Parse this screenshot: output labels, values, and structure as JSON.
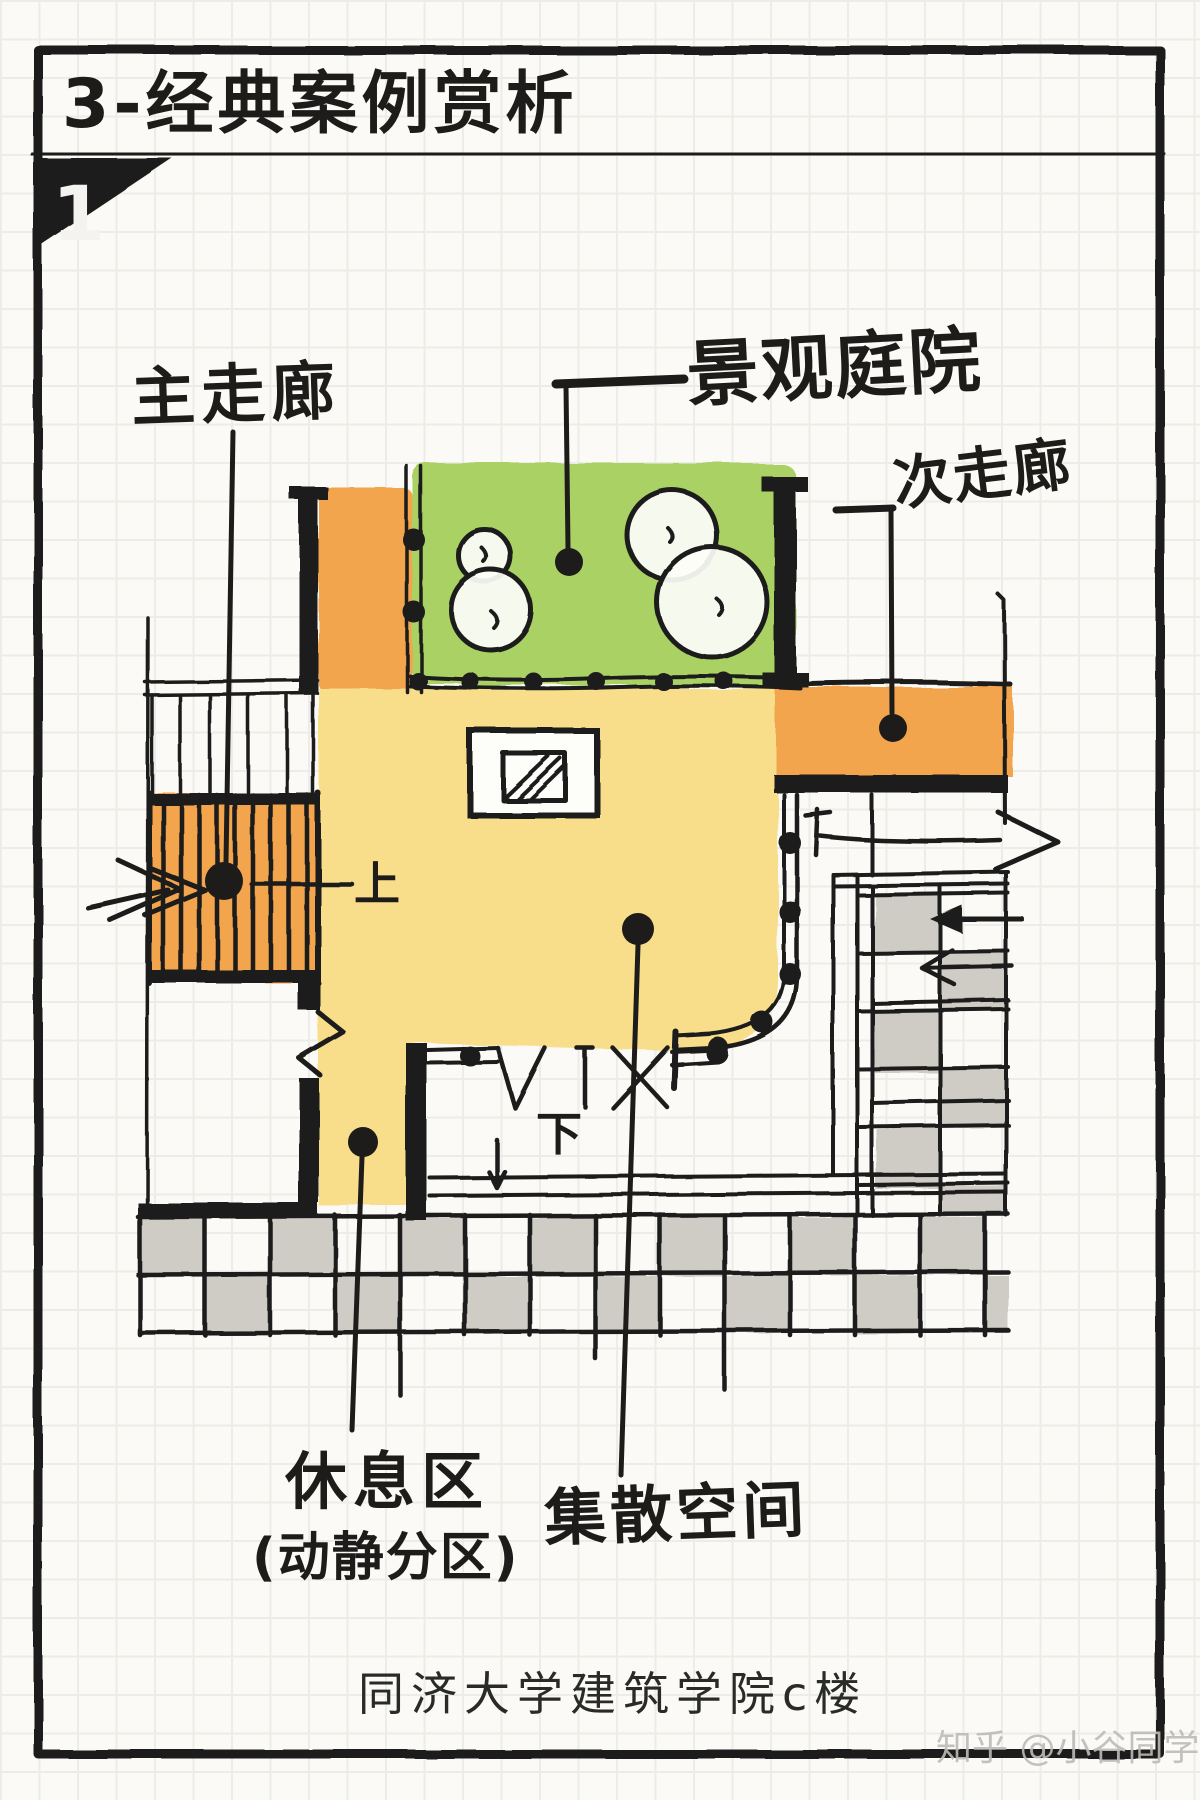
{
  "header": {
    "title": "3-经典案例赏析",
    "page_badge": "1"
  },
  "plan": {
    "labels": {
      "main_corridor": "主走廊",
      "landscape_courtyard": "景观庭院",
      "secondary_corridor": "次走廊",
      "rest_area": "休息区",
      "rest_area_sub": "(动静分区)",
      "gathering_space": "集散空间"
    },
    "markers": {
      "stair_up": "上",
      "stair_down": "下"
    }
  },
  "footer": {
    "caption": "同济大学建筑学院c楼",
    "watermark": "知乎 @小谷同学"
  },
  "colors": {
    "paper": "#fbfaf6",
    "grid": "#ecede8",
    "ink": "#1d1c1a",
    "courtyard_green": "#a9d164",
    "corridor_orange": "#f3a54d",
    "space_yellow": "#f8dd8a",
    "paving_gray": "#cfcbc5",
    "watermark_gray": "#bdbbb8"
  }
}
